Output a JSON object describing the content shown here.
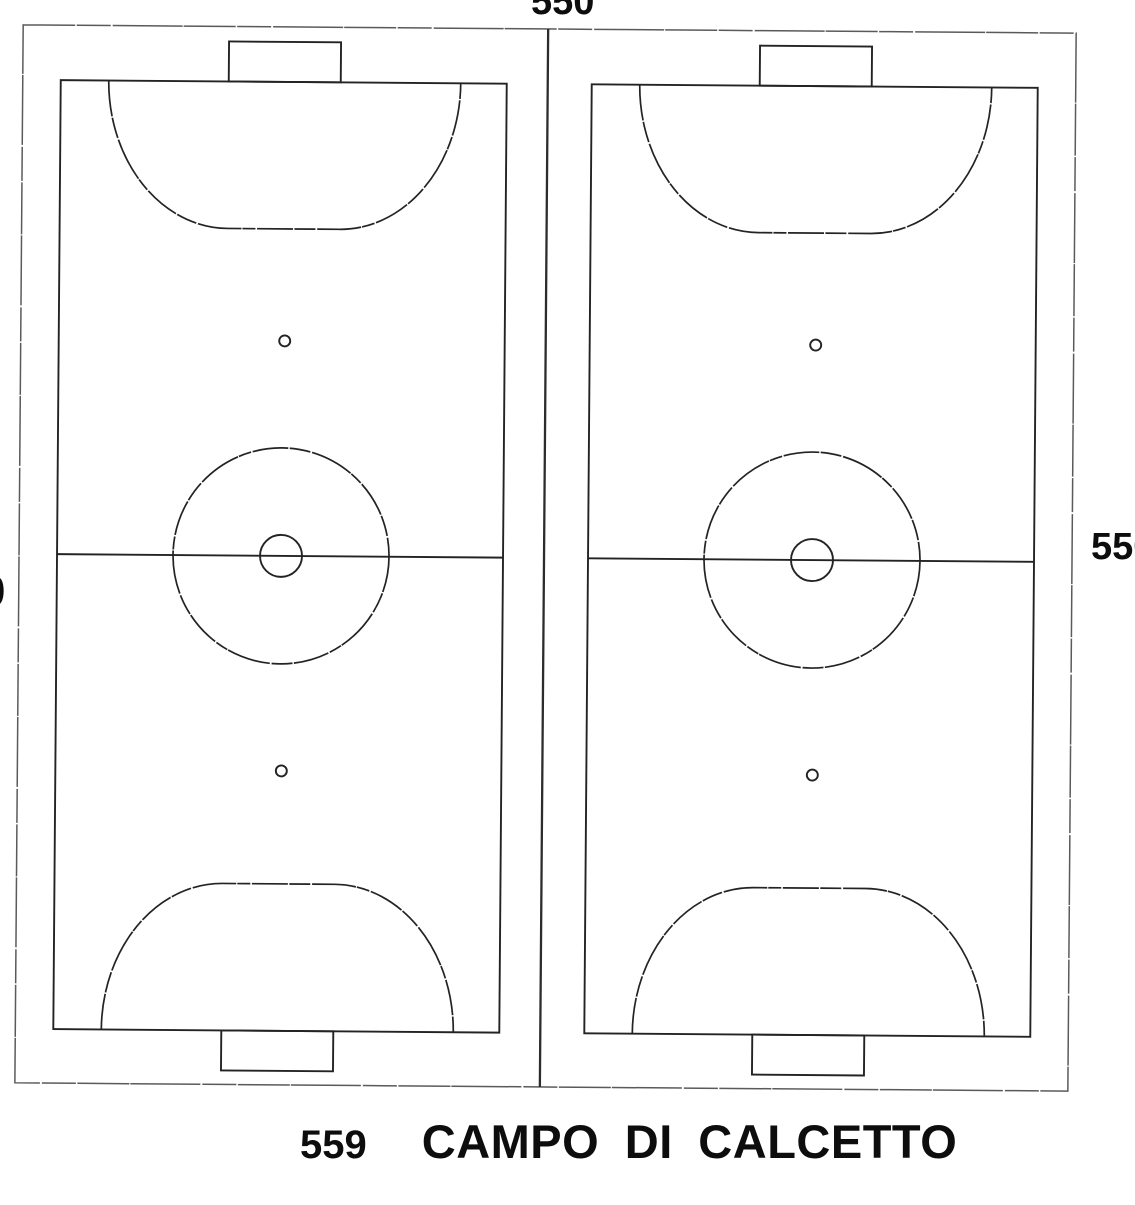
{
  "document": {
    "kind": "scanned technical drawing of twin five-a-side football pitches",
    "caption": {
      "number": "559",
      "title": "CAMPO DI CALCETTO"
    },
    "dimensions": {
      "top": "550",
      "right": "550",
      "left_partial": "0"
    },
    "colors": {
      "paper": "#ffffff",
      "ink": "#232323",
      "frame_line": "#5a5a5a",
      "text": "#0d0d0d"
    }
  },
  "pitches": [
    {
      "id": "pitch-left",
      "features": [
        "outline",
        "goal-top",
        "goal-bottom",
        "penalty-area-top",
        "penalty-area-bottom",
        "penalty-spot-top",
        "penalty-spot-bottom",
        "halfway-line",
        "center-circle",
        "center-spot"
      ]
    },
    {
      "id": "pitch-right",
      "features": [
        "outline",
        "goal-top",
        "goal-bottom",
        "penalty-area-top",
        "penalty-area-bottom",
        "penalty-spot-top",
        "penalty-spot-bottom",
        "halfway-line",
        "center-circle",
        "center-spot"
      ]
    }
  ]
}
